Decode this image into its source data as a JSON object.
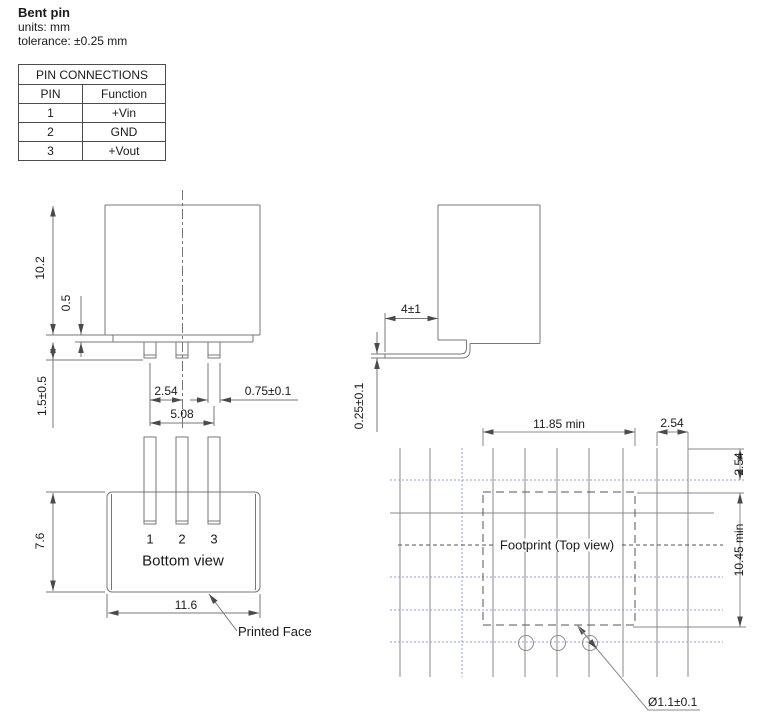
{
  "header": {
    "title": "Bent pin",
    "units": "units: mm",
    "tolerance": "tolerance: ±0.25 mm"
  },
  "pin_table": {
    "title": "PIN CONNECTIONS",
    "col_pin": "PIN",
    "col_function": "Function",
    "rows": [
      {
        "pin": "1",
        "function": "+Vin"
      },
      {
        "pin": "2",
        "function": "GND"
      },
      {
        "pin": "3",
        "function": "+Vout"
      }
    ]
  },
  "front_view": {
    "dims": {
      "body_height": "10.2",
      "standoff": "0.5",
      "pin_length": "1.5±0.5",
      "pin_pitch": "2.54",
      "pin_span": "5.08",
      "pin_width": "0.75±0.1"
    }
  },
  "side_view": {
    "dims": {
      "bent_length": "4±1",
      "pin_thickness": "0.25±0.1"
    }
  },
  "bottom_view": {
    "label": "Bottom view",
    "pin_numbers": [
      "1",
      "2",
      "3"
    ],
    "printed_face": "Printed Face",
    "dims": {
      "depth": "7.6",
      "width": "11.6"
    }
  },
  "footprint": {
    "label": "Footprint (Top view)",
    "dims": {
      "width_min": "11.85 min",
      "pitch_right": "2.54",
      "pitch_top": "2.54",
      "depth_min": "10.45 min",
      "hole_diameter": "Ø1.1±0.1"
    }
  },
  "colors": {
    "drawing_line": "#777777",
    "dashed_line": "#555555",
    "grid_accent": "#9a9ade",
    "text": "#1a1a1a"
  }
}
